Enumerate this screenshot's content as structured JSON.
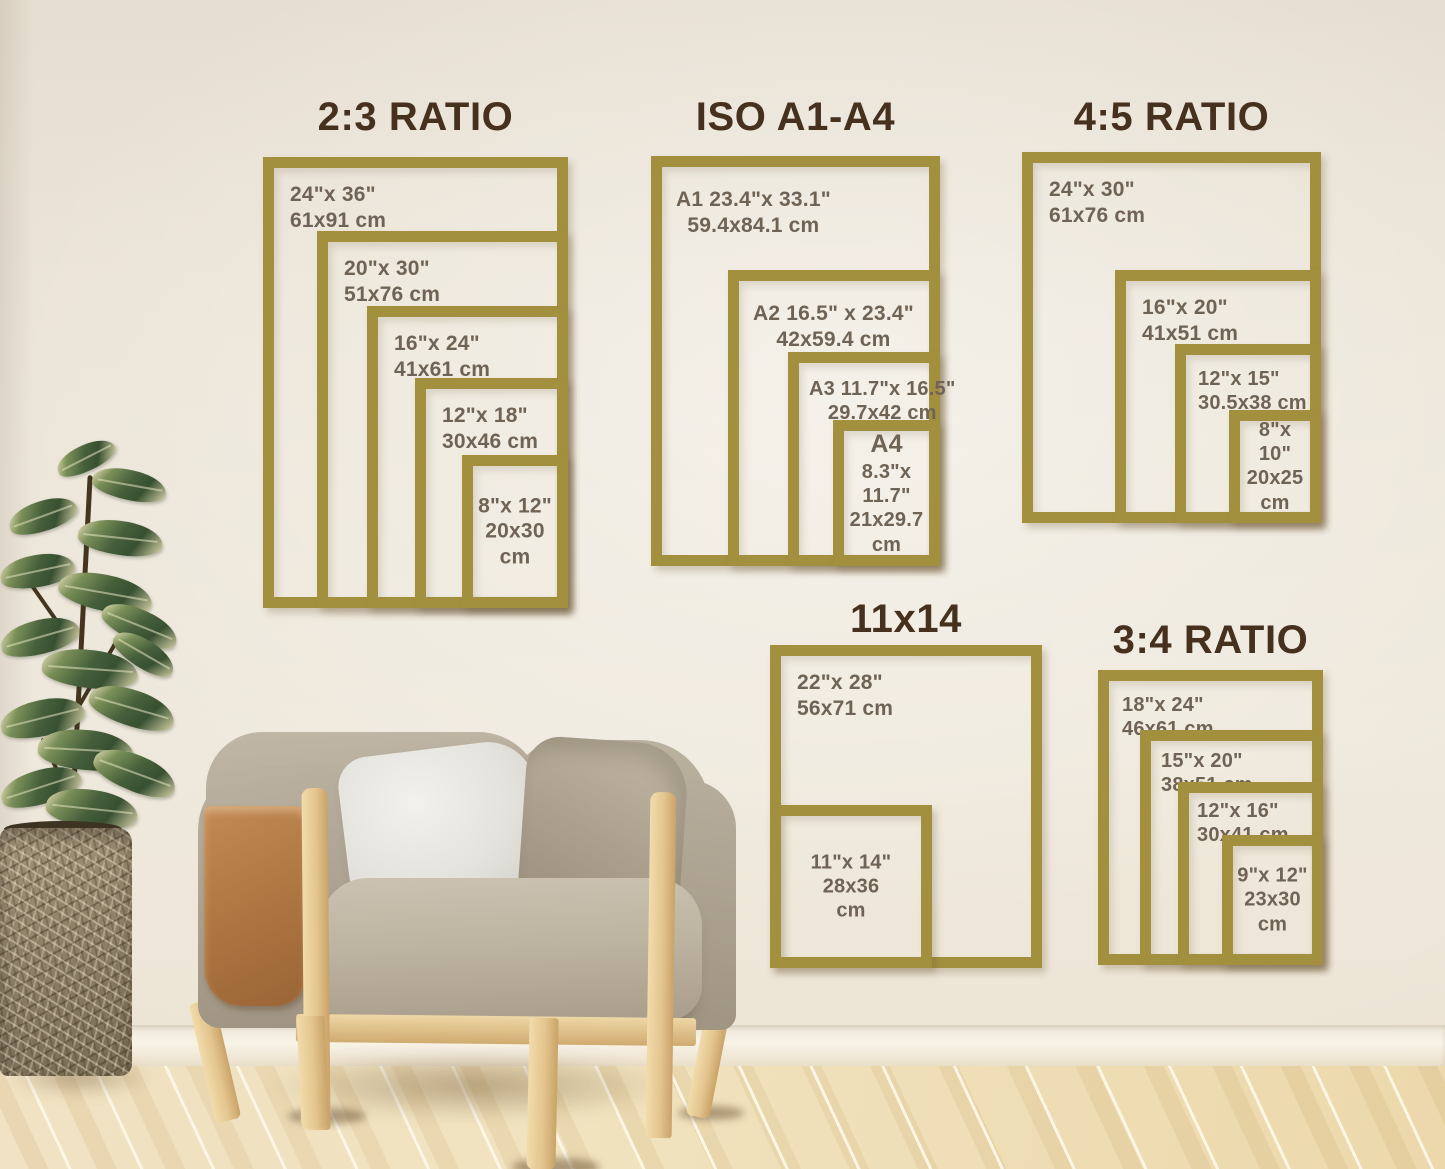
{
  "palette": {
    "frame_gold": "#a3903e",
    "title_brown": "#46311f",
    "label_brown": "#6f6355"
  },
  "groups": [
    {
      "title": "2:3 RATIO",
      "sizes": [
        {
          "l1": "24\"x 36\"",
          "l2": "61x91 cm"
        },
        {
          "l1": "20\"x 30\"",
          "l2": "51x76 cm"
        },
        {
          "l1": "16\"x 24\"",
          "l2": "41x61 cm"
        },
        {
          "l1": "12\"x 18\"",
          "l2": "30x46 cm"
        },
        {
          "l1": "8\"x 12\"",
          "l2": "20x30 cm"
        }
      ]
    },
    {
      "title": "ISO A1-A4",
      "sizes": [
        {
          "l1": "A1 23.4\"x 33.1\"",
          "l2": "59.4x84.1 cm"
        },
        {
          "l1": "A2 16.5\" x 23.4\"",
          "l2": "42x59.4 cm"
        },
        {
          "l1": "A3 11.7\"x 16.5\"",
          "l2": "29.7x42 cm"
        },
        {
          "l1": "A4",
          "l2": "8.3\"x 11.7\"",
          "l3": "21x29.7",
          "l4": "cm"
        }
      ]
    },
    {
      "title": "4:5 RATIO",
      "sizes": [
        {
          "l1": "24\"x 30\"",
          "l2": "61x76 cm"
        },
        {
          "l1": "16\"x 20\"",
          "l2": "41x51 cm"
        },
        {
          "l1": "12\"x 15\"",
          "l2": "30.5x38 cm"
        },
        {
          "l1": "8\"x 10\"",
          "l2": "20x25",
          "l3": "cm"
        }
      ]
    },
    {
      "title": "11x14",
      "sizes": [
        {
          "l1": "22\"x 28\"",
          "l2": "56x71 cm"
        },
        {
          "l1": "11\"x 14\"",
          "l2": "28x36",
          "l3": "cm"
        }
      ]
    },
    {
      "title": "3:4 RATIO",
      "sizes": [
        {
          "l1": "18\"x 24\"",
          "l2": "46x61 cm"
        },
        {
          "l1": "15\"x 20\"",
          "l2": "38x51 cm"
        },
        {
          "l1": "12\"x 16\"",
          "l2": "30x41 cm"
        },
        {
          "l1": "9\"x 12\"",
          "l2": "23x30",
          "l3": "cm"
        }
      ]
    }
  ]
}
